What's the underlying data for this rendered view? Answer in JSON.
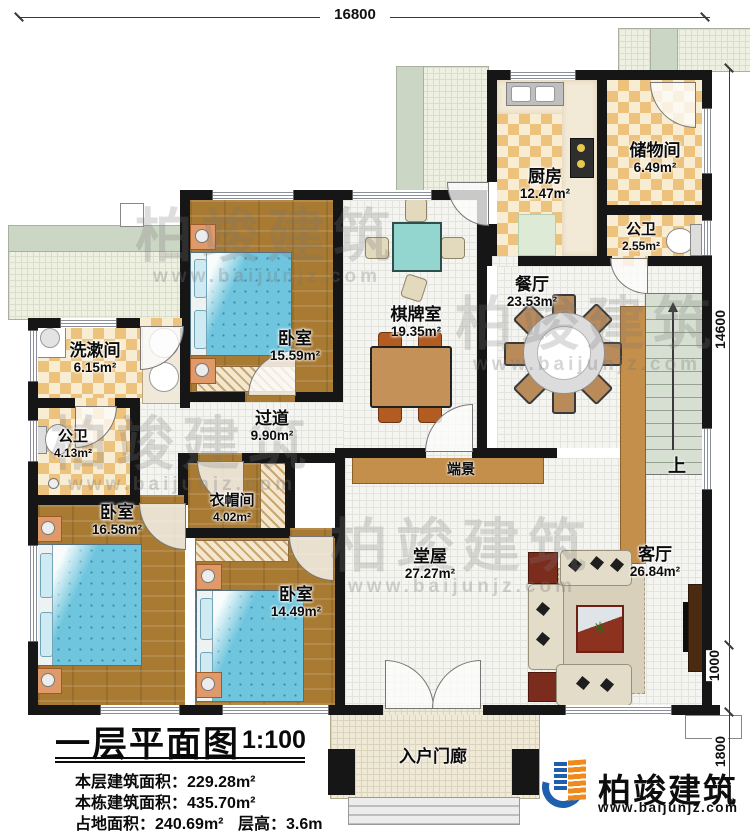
{
  "title_block": {
    "title": "一层平面图",
    "scale": "1:100",
    "stats": [
      {
        "label": "本层建筑面积：",
        "value": "229.28m²"
      },
      {
        "label": "本栋建筑面积：",
        "value": "435.70m²"
      },
      {
        "label": "占地面积：",
        "value": "240.69m²"
      },
      {
        "label": "层高：",
        "value": "3.6m"
      }
    ]
  },
  "rooms": [
    {
      "name": "厨房",
      "area": "12.47m²"
    },
    {
      "name": "储物间",
      "area": "6.49m²"
    },
    {
      "name": "公卫",
      "area": "2.55m²"
    },
    {
      "name": "餐厅",
      "area": "23.53m²"
    },
    {
      "name": "卧室",
      "area": "15.59m²"
    },
    {
      "name": "棋牌室",
      "area": "19.35m²"
    },
    {
      "name": "洗漱间",
      "area": "6.15m²"
    },
    {
      "name": "公卫",
      "area": "4.13m²"
    },
    {
      "name": "过道",
      "area": "9.90m²"
    },
    {
      "name": "衣帽间",
      "area": "4.02m²"
    },
    {
      "name": "卧室",
      "area": "16.58m²"
    },
    {
      "name": "卧室",
      "area": "14.49m²"
    },
    {
      "name": "堂屋",
      "area": "27.27m²"
    },
    {
      "name": "客厅",
      "area": "26.84m²"
    }
  ],
  "annotations": {
    "porch": "入户门廊",
    "console": "端景",
    "stairs_up": "上"
  },
  "dimensions": {
    "top": "16800",
    "right": "14600",
    "right_mid": "1000",
    "right_bottom": "1800"
  },
  "brand": {
    "name": "柏竣建筑",
    "website": "www.baijunjz.com"
  },
  "colors": {
    "wall": "#161616",
    "wood_floor": "#a87a32",
    "tile_accent": "#ecc27c",
    "bed": "#6fc5dd",
    "outdoor": "#eef0e2",
    "brand_blue": "#1f5fae",
    "brand_orange": "#ef8a1c"
  }
}
